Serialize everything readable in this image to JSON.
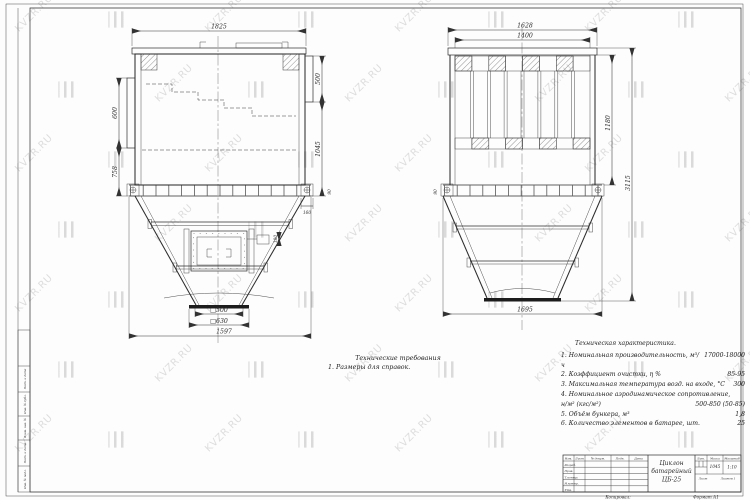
{
  "watermark": {
    "text": "KVZR.RU"
  },
  "notes": {
    "title": "Технические требования",
    "line1": "1. Размеры для справок."
  },
  "tech": {
    "title": "Техническая характеристика.",
    "rows": [
      {
        "label": "1. Номинальная производительность, м³/ч",
        "value": "17000-18000"
      },
      {
        "label": "2. Коэффициент очистки, η %",
        "value": "85-95"
      },
      {
        "label": "3. Максимальная температура возд. на входе, °С",
        "value": "300"
      },
      {
        "label": "4. Номинальное аэродинамическое сопротивление,",
        "value": ""
      },
      {
        "label": "н/м² (кгс/м²)",
        "value": "500-850 (50-85)"
      },
      {
        "label": "5. Объём бункера, м³",
        "value": "1,8"
      },
      {
        "label": "6. Количество элементов в батарее, шт.",
        "value": "25"
      }
    ]
  },
  "dims": {
    "front": {
      "top": "1825",
      "inlet_height": "600",
      "lower_height": "758",
      "outlet_height": "500",
      "body_height": "1045",
      "flange_plate": "160",
      "joint": "90",
      "hatch_offset": "180",
      "outlet_inner": "□500",
      "outlet_outer": "□630",
      "bottom": "1597"
    },
    "side": {
      "top": "1628",
      "top_inner": "1400",
      "body_height": "1180",
      "total_height": "3115",
      "joint": "90",
      "bottom": "1695"
    }
  },
  "title_block": {
    "doc_title": [
      "Циклон",
      "батарейный",
      "ЦБ-25"
    ],
    "header_cols": [
      "Изм.",
      "Лист",
      "№ докум.",
      "Подп.",
      "Дата"
    ],
    "row_labels": [
      "Разраб.",
      "Пров.",
      "Т.контр.",
      "Н.контр.",
      "Утв."
    ],
    "lit_label": "Лит.",
    "mass_label": "Масса",
    "scale_label": "Масштаб",
    "mass_value": "1045",
    "scale_value": "1:10",
    "sheet_label": "Лист",
    "sheets_label": "Листов 1",
    "copied_label": "Копировал:",
    "format_label": "Формат А1"
  },
  "side_stamp": {
    "labels": [
      "Подп. и дата",
      "Инв. № дубл.",
      "Взам. инв. №",
      "Подп. и дата",
      "Инв. № подл."
    ]
  }
}
